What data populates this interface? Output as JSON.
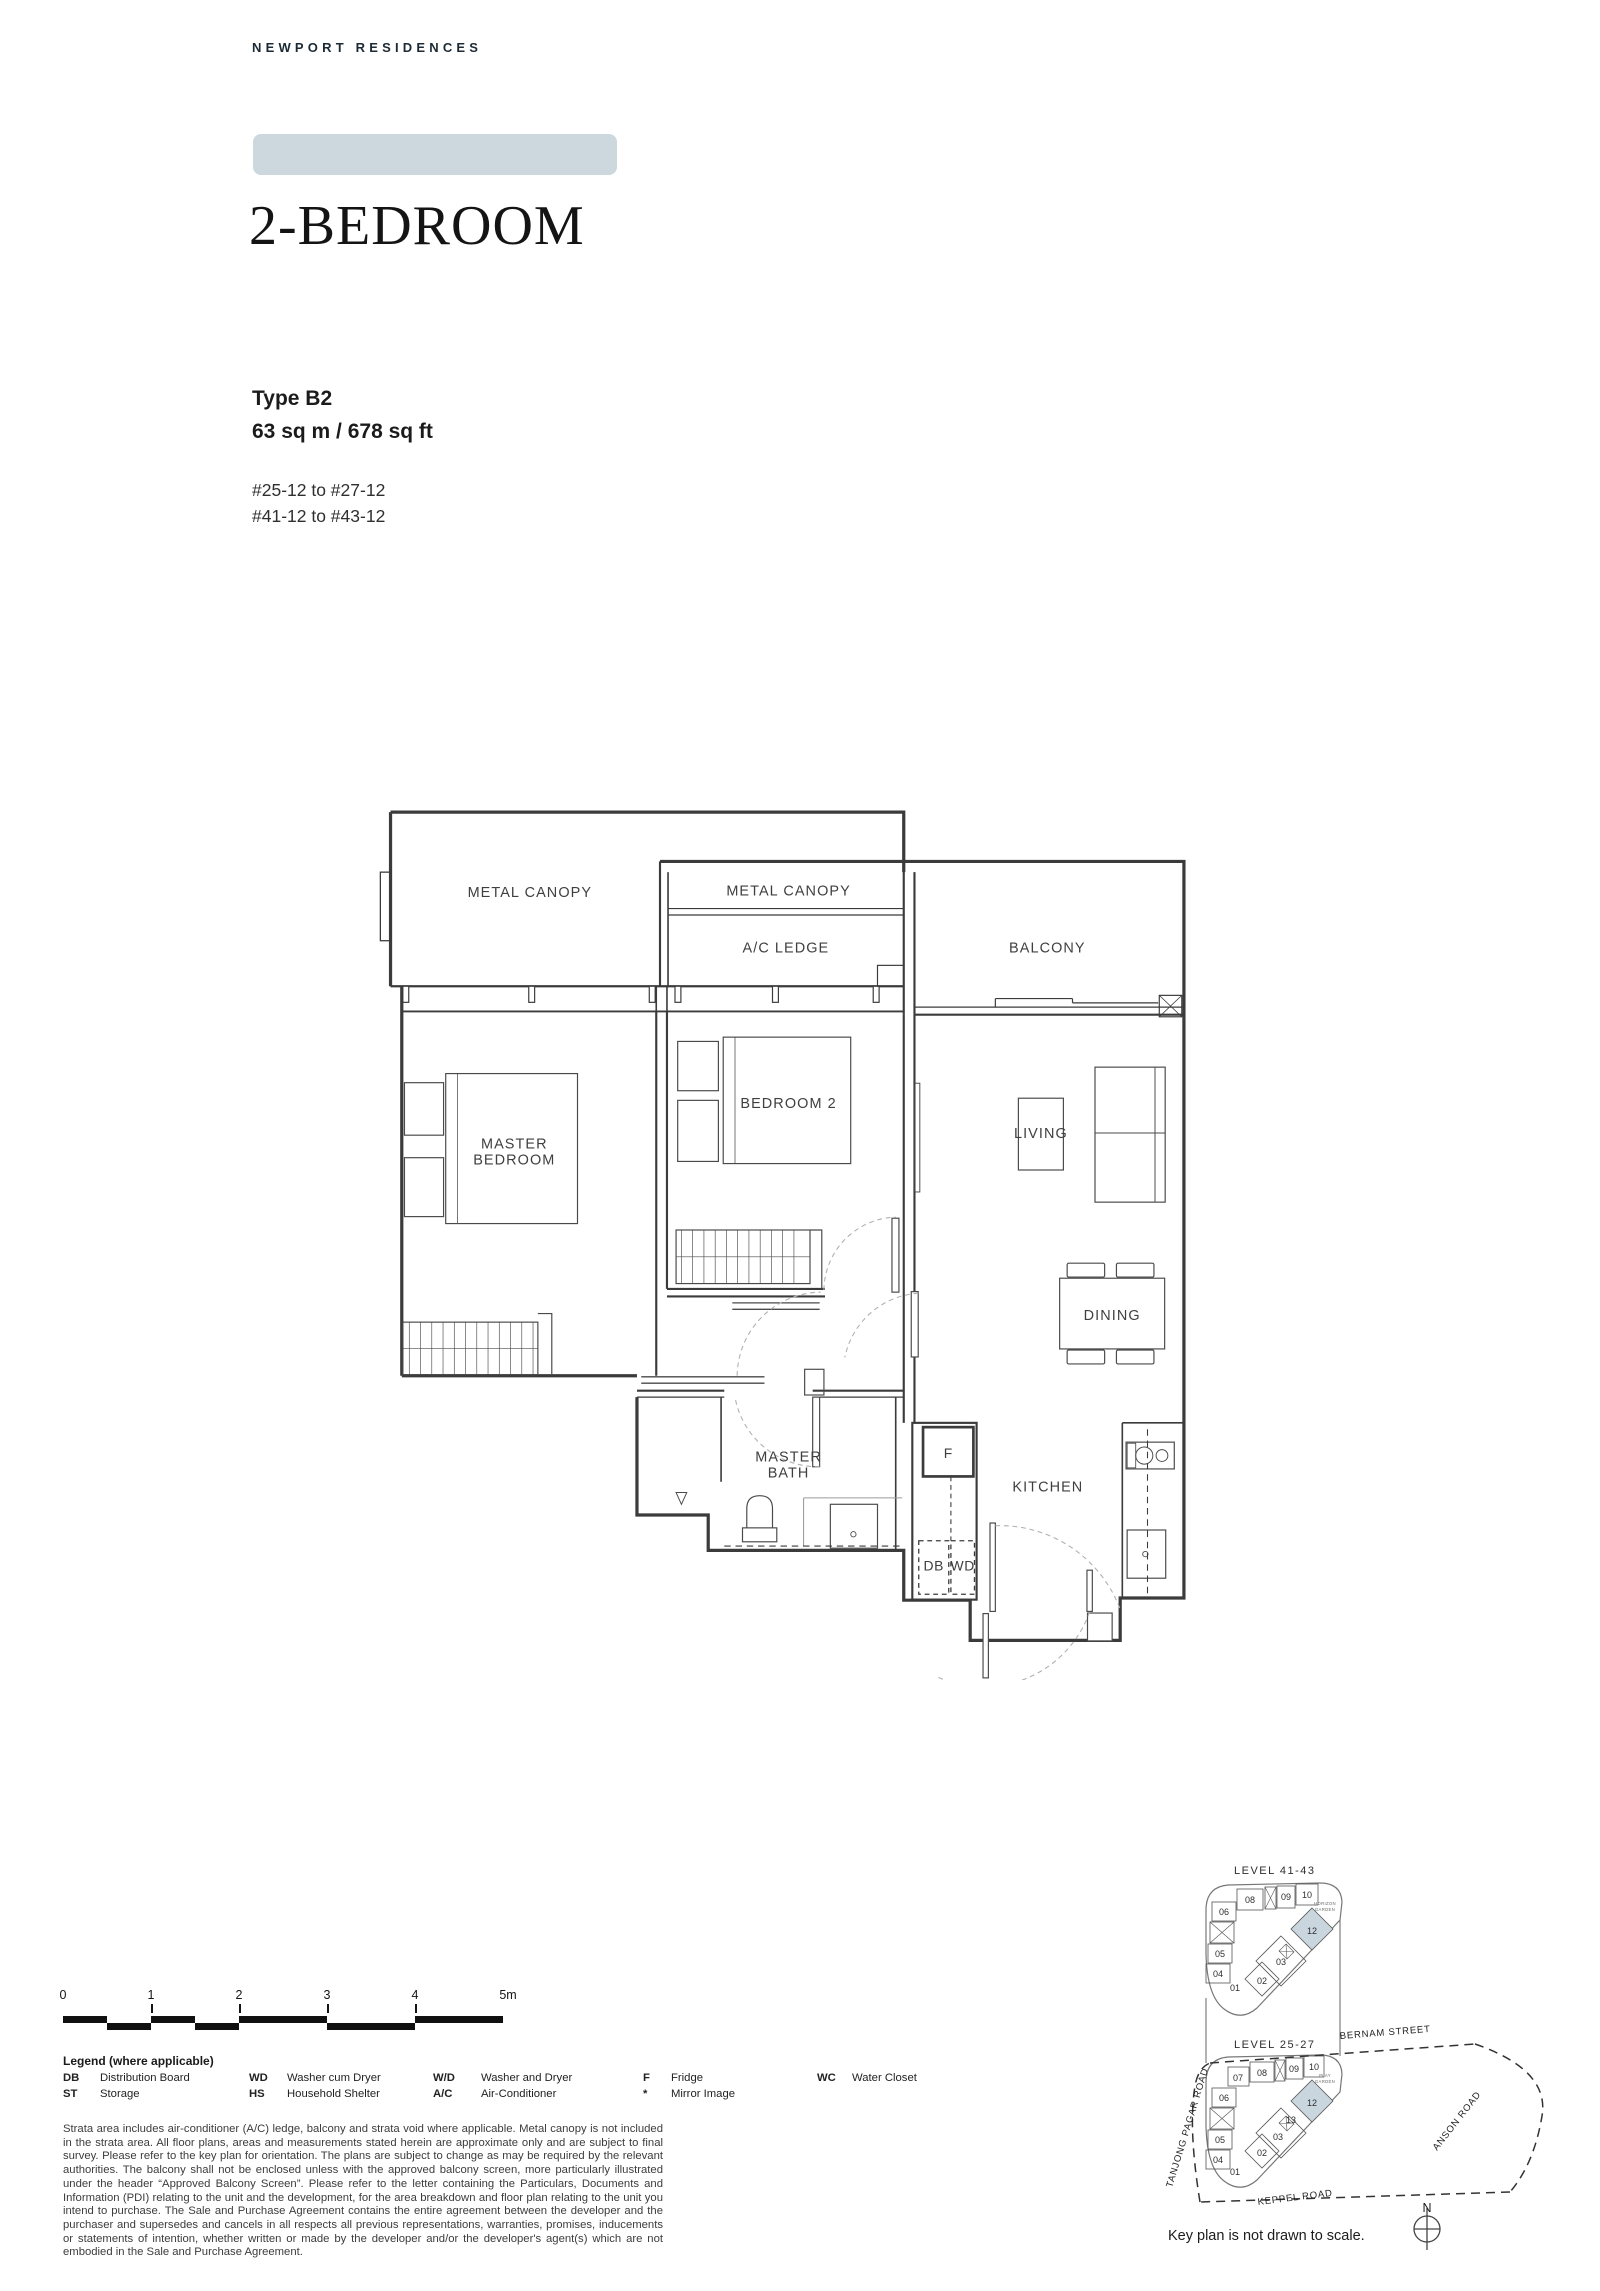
{
  "page": {
    "brand": "NEWPORT RESIDENCES",
    "title": "2-BEDROOM",
    "type_label": "Type B2",
    "area": "63 sq m / 678 sq ft",
    "units_range_1": "#25-12 to #27-12",
    "units_range_2": "#41-12 to #43-12",
    "accent_color": "#ccd7de"
  },
  "floorplan": {
    "highlight_color": "#c9d6de",
    "labels": {
      "metal_canopy_left": "METAL CANOPY",
      "metal_canopy_mid": "METAL CANOPY",
      "ac_ledge": "A/C LEDGE",
      "balcony": "BALCONY",
      "master_line1": "MASTER",
      "master_line2": "BEDROOM",
      "bedroom2": "BEDROOM 2",
      "living": "LIVING",
      "dining": "DINING",
      "bath_line1": "MASTER",
      "bath_line2": "BATH",
      "kitchen": "KITCHEN",
      "fridge": "F",
      "db": "DB",
      "wd": "WD"
    }
  },
  "scalebar": {
    "ticks": [
      "0",
      "1",
      "2",
      "3",
      "4",
      "5m"
    ]
  },
  "legend": {
    "title": "Legend (where applicable)",
    "entries": [
      {
        "abbr": "DB",
        "label": "Distribution Board"
      },
      {
        "abbr": "ST",
        "label": "Storage"
      },
      {
        "abbr": "WD",
        "label": "Washer cum Dryer"
      },
      {
        "abbr": "HS",
        "label": "Household Shelter"
      },
      {
        "abbr": "W/D",
        "label": "Washer and Dryer"
      },
      {
        "abbr": "A/C",
        "label": "Air-Conditioner"
      },
      {
        "abbr": "F",
        "label": "Fridge"
      },
      {
        "abbr": "*",
        "label": "Mirror Image"
      },
      {
        "abbr": "WC",
        "label": "Water Closet"
      }
    ]
  },
  "disclaimer": "Strata area includes air-conditioner (A/C) ledge, balcony and strata void where applicable. Metal canopy is not included in the strata area. All floor plans, areas and measurements stated herein are approximate only and are subject to final survey. Please refer to the key plan for orientation. The plans are subject to change as may be required by the relevant authorities. The balcony shall not be enclosed unless with the approved balcony screen, more particularly illustrated under the header “Approved Balcony Screen”. Please refer to the letter containing the Particulars, Documents and Information (PDI) relating to the unit and the development, for the area breakdown and floor plan relating to the unit you intend to purchase. The Sale and Purchase Agreement contains the entire agreement between the developer and the purchaser and supersedes and cancels in all respects all previous representations, warranties, promises, inducements or statements of intention, whether written or made by the developer and/or the developer's agent(s) which are not embodied in the Sale and Purchase Agreement.",
  "keyplan": {
    "l1_title": "LEVEL 41-43",
    "l2_title": "LEVEL 25-27",
    "l1_units": [
      "08",
      "09",
      "10",
      "06",
      "05",
      "04",
      "01",
      "02",
      "03",
      "12"
    ],
    "l2_units": [
      "07",
      "08",
      "09",
      "10",
      "06",
      "05",
      "04",
      "01",
      "02",
      "03",
      "13",
      "12"
    ],
    "l1_garden": [
      "HORIZON",
      "GARDEN"
    ],
    "l2_garden": [
      "PLAY",
      "GARDEN"
    ],
    "streets": {
      "bernam": "BERNAM STREET",
      "tanjong_pagar": "TANJONG PAGAR ROAD",
      "anson": "ANSON ROAD",
      "keppel": "KEPPEL ROAD"
    },
    "note": "Key plan is not drawn to scale.",
    "north": "N"
  }
}
